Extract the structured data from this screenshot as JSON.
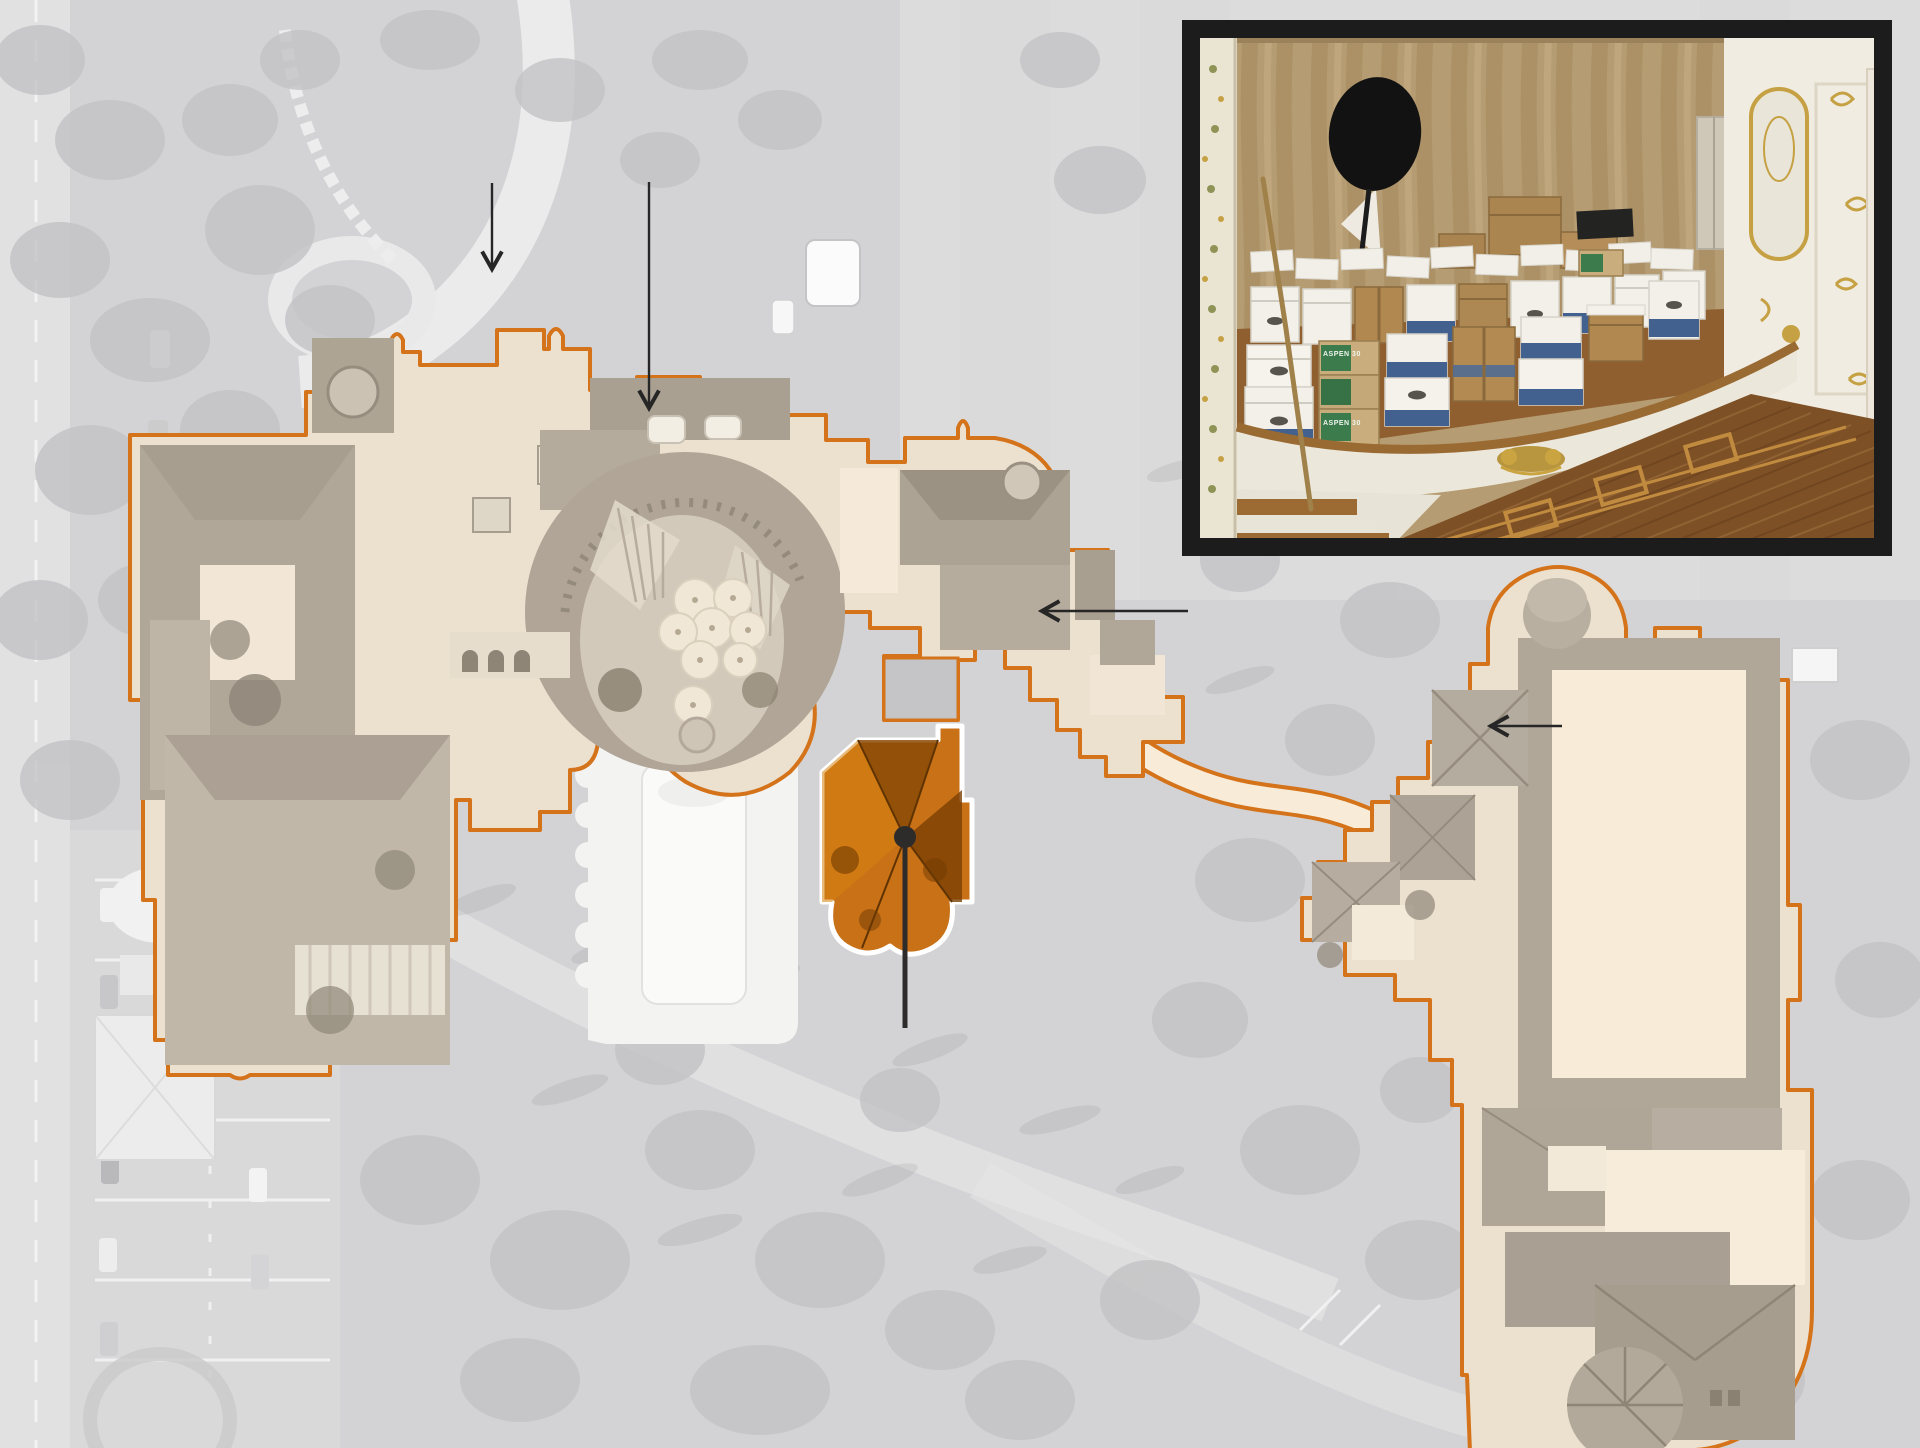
{
  "graphic": {
    "type": "annotated-aerial-map",
    "subject": "estate aerial view with orange-outlined building footprints, one orange-highlighted building with marker, four pointer arrows and a photo inset of stacked boxes on an ornate stage"
  },
  "colors": {
    "canvas_gray": "#d3d3d5",
    "road_gray": "#e1e1e2",
    "lot_gray": "#d9d9da",
    "tree_gray": "#c3c3c5",
    "lawn_gray": "#dcdcdd",
    "outline_orange": "#d4731a",
    "interior_cream": "#ece0cf",
    "pale_cream": "#f8ecd9",
    "roof_gray": "#b1a799",
    "roof_gray_dark": "#a0968a",
    "roof_gray_light": "#cbc2b3",
    "highlight_orange": "#c87117",
    "highlight_orange_dark": "#6f3a02",
    "highlight_outline_white": "#ffffff",
    "marker_black": "#2d2c2b",
    "arrow_black": "#262626",
    "inset_border_black": "#1c1c1c",
    "pool_white": "#f3f3f2",
    "curtain_tan": "#b69c72",
    "curtain_fold": "#a5895e",
    "wall_white": "#f0ece1",
    "gold": "#c5a143",
    "stage_wood": "#8f5f30",
    "parquet_brown": "#7e5026",
    "box_white": "#f2f0e9",
    "box_brown": "#b08850",
    "box_blue": "#43618e",
    "box_green": "#3c7c4c"
  },
  "map": {
    "regions": [
      {
        "id": "main-residence",
        "style": "orange-outline"
      },
      {
        "id": "east-building-complex",
        "style": "orange-outline"
      },
      {
        "id": "highlighted-building",
        "style": "orange-fill-white-outline"
      }
    ],
    "marker": {
      "x": 905,
      "y": 837,
      "r": 11,
      "leader_y2": 1028,
      "stroke_width": 5
    },
    "arrows": [
      {
        "id": "arrow-north-drive",
        "x1": 492,
        "y1": 183,
        "x2": 492,
        "y2": 268
      },
      {
        "id": "arrow-main-entrance",
        "x1": 649,
        "y1": 182,
        "x2": 649,
        "y2": 407
      },
      {
        "id": "arrow-east-wing",
        "x1": 1188,
        "y1": 611,
        "x2": 1043,
        "y2": 611
      },
      {
        "id": "arrow-annex-roof",
        "x1": 1562,
        "y1": 726,
        "x2": 1492,
        "y2": 726
      }
    ]
  },
  "inset": {
    "x": 1191,
    "y": 29,
    "width": 692,
    "height": 518,
    "border_px": 9,
    "subject": "stacked-document-boxes-on-ballroom-stage",
    "box_label_text": "ASPEN 30"
  }
}
